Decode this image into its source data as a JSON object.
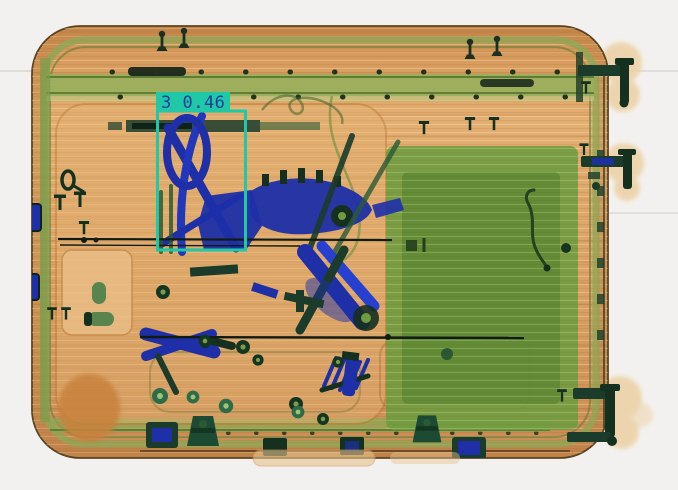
{
  "meta": {
    "description": "X-ray baggage security scan of a suitcase with one object-detection bounding box overlay",
    "image_width": 678,
    "image_height": 490
  },
  "detection": {
    "class_id": "3",
    "confidence": "0.46",
    "label": "3 0.46",
    "box_color": "#1fc9a8",
    "text_color": "#1e3c9c",
    "bbox": {
      "x": 158,
      "y": 111,
      "width": 88,
      "height": 139
    }
  },
  "scene": {
    "background_color": "#f3f1ef",
    "case_color": "#dca264",
    "organic_region_color": "#6f9c40",
    "metal_dark_color": "#1b3c2b",
    "dense_blue_color": "#1e2fa8",
    "objects": [
      "suitcase-shell",
      "telescopic-handle-rail",
      "hinges",
      "feet-wheels",
      "hand-tools-cluster",
      "drill",
      "wrenches",
      "pliers",
      "nuts-and-bolts",
      "fabric-bundle",
      "cable"
    ]
  }
}
